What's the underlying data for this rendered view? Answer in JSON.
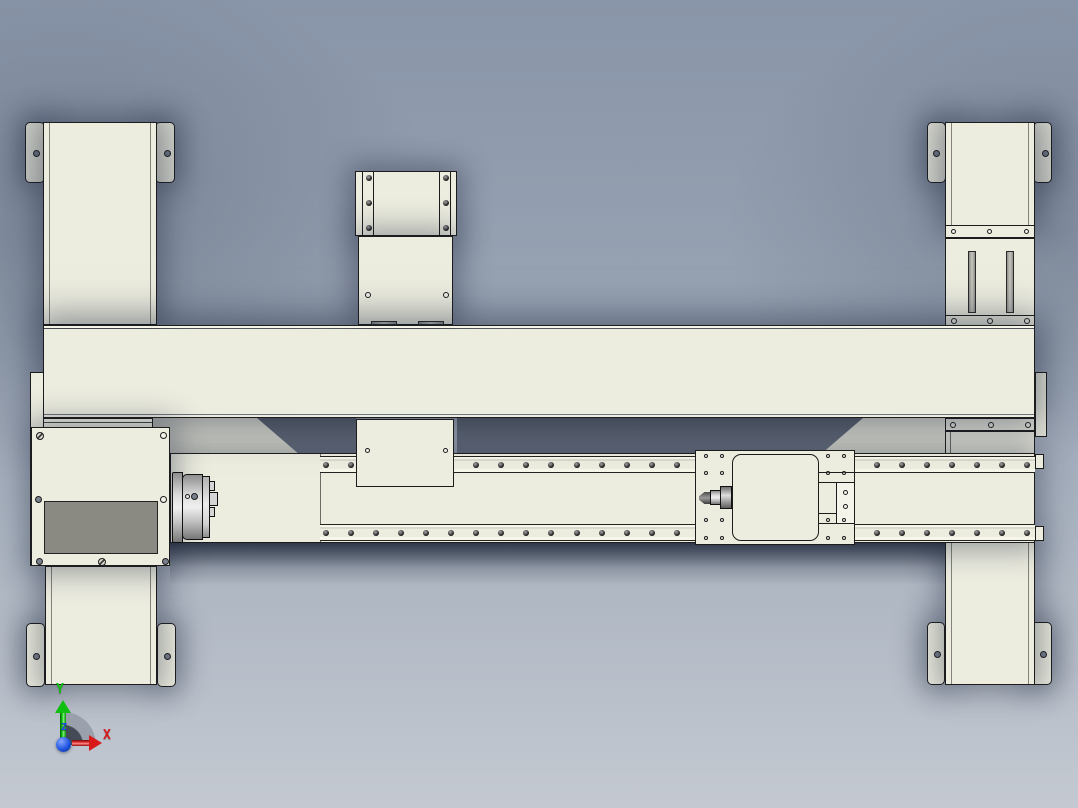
{
  "colors": {
    "bg_top": "#8995A8",
    "bg_bottom": "#C4C9D1",
    "part": "#ECECDF",
    "part_shade": "#E4E4D7",
    "edge": "#1C1C1C",
    "panel_gray": "#8A8A82",
    "hole_gray": "#78808D",
    "triad_x": "#D81A1A",
    "triad_y": "#0FBF0F",
    "triad_z": "#2244E0"
  },
  "triad": {
    "x": "X",
    "y": "Y",
    "z": "Z"
  },
  "bolt_rows": {
    "top_rail": {
      "count": 29,
      "x_start": 3,
      "spacing": 25.05,
      "y": 5,
      "size": 6
    },
    "bottom_rail": {
      "count": 29,
      "x_start": 3,
      "spacing": 25.05,
      "y": 5,
      "size": 6
    }
  },
  "details": {
    "col_tl_tab_l": [
      {
        "k": "pin",
        "x": 7,
        "y": 27
      }
    ],
    "col_tl_tab_r": [
      {
        "k": "pin",
        "x": 8,
        "y": 27
      }
    ],
    "col_tm_upper": [
      {
        "k": "bolt",
        "x": 10,
        "y": 3
      },
      {
        "k": "bolt",
        "x": 10,
        "y": 28
      },
      {
        "k": "bolt",
        "x": 10,
        "y": 53
      },
      {
        "k": "bolt",
        "x": 87,
        "y": 3
      },
      {
        "k": "bolt",
        "x": 87,
        "y": 28
      },
      {
        "k": "bolt",
        "x": 87,
        "y": 53
      }
    ],
    "col_tm_lower": [
      {
        "k": "hole",
        "x": 6,
        "y": 55
      },
      {
        "k": "hole",
        "x": 84,
        "y": 55
      },
      {
        "k": "slot",
        "x": 12,
        "y": 84,
        "w": 26,
        "h": 4
      },
      {
        "k": "slot",
        "x": 59,
        "y": 84,
        "w": 26,
        "h": 4
      }
    ],
    "col_tm_below": [
      {
        "k": "hole",
        "x": 8,
        "y": 28,
        "w": 5,
        "h": 5
      },
      {
        "k": "hole",
        "x": 86,
        "y": 28,
        "w": 5,
        "h": 5
      }
    ],
    "col_tr_tab_l": [
      {
        "k": "pin",
        "x": 5,
        "y": 27
      }
    ],
    "col_tr_tab_r": [
      {
        "k": "pin",
        "x": 8,
        "y": 27
      }
    ],
    "col_tr_strip1": [
      {
        "k": "hole",
        "x": 5,
        "y": 3,
        "w": 5,
        "h": 5
      },
      {
        "k": "hole",
        "x": 41,
        "y": 3,
        "w": 5,
        "h": 5
      },
      {
        "k": "hole",
        "x": 78,
        "y": 3,
        "w": 5,
        "h": 5
      }
    ],
    "col_tr_mid": [
      {
        "k": "slot",
        "x": 22,
        "y": 12,
        "w": 8,
        "h": 62
      },
      {
        "k": "slot",
        "x": 60,
        "y": 12,
        "w": 8,
        "h": 62
      }
    ],
    "col_tr_strip2": [
      {
        "k": "hole",
        "x": 5,
        "y": 2
      },
      {
        "k": "hole",
        "x": 41,
        "y": 2
      },
      {
        "k": "hole",
        "x": 78,
        "y": 2
      }
    ],
    "col_br_strip": [
      {
        "k": "hole",
        "x": 4,
        "y": 3
      },
      {
        "k": "hole",
        "x": 42,
        "y": 3
      },
      {
        "k": "hole",
        "x": 79,
        "y": 3
      }
    ],
    "col_bl_tab_l": [
      {
        "k": "pin",
        "x": 6,
        "y": 29
      }
    ],
    "col_bl_tab_r": [
      {
        "k": "pin",
        "x": 6,
        "y": 29
      }
    ],
    "col_br_tab_l": [
      {
        "k": "pin",
        "x": 6,
        "y": 28
      }
    ],
    "col_br_tab_r": [
      {
        "k": "pin",
        "x": 9,
        "y": 28
      }
    ],
    "headstock": [
      {
        "k": "screw",
        "x": 4,
        "y": 4,
        "w": 8,
        "h": 8
      },
      {
        "k": "hole",
        "x": 128,
        "y": 4,
        "w": 7,
        "h": 7
      },
      {
        "k": "pin",
        "x": 3,
        "y": 68
      },
      {
        "k": "hole",
        "x": 128,
        "y": 68,
        "w": 7,
        "h": 7
      },
      {
        "k": "pin",
        "x": 4,
        "y": 130
      },
      {
        "k": "screw",
        "x": 66,
        "y": 130,
        "w": 8,
        "h": 8
      },
      {
        "k": "pin",
        "x": 130,
        "y": 130
      }
    ],
    "chuck": [
      {
        "k": "hole",
        "x": 14,
        "y": 24,
        "w": 5,
        "h": 5
      },
      {
        "k": "pin",
        "x": 20,
        "y": 23
      }
    ],
    "carriage": [
      {
        "k": "hole",
        "x": 8,
        "y": 3,
        "w": 4,
        "h": 4
      },
      {
        "k": "hole",
        "x": 24,
        "y": 3,
        "w": 4,
        "h": 4
      },
      {
        "k": "hole",
        "x": 8,
        "y": 20,
        "w": 4,
        "h": 4
      },
      {
        "k": "hole",
        "x": 24,
        "y": 20,
        "w": 4,
        "h": 4
      },
      {
        "k": "hole",
        "x": 8,
        "y": 67,
        "w": 4,
        "h": 4
      },
      {
        "k": "hole",
        "x": 24,
        "y": 67,
        "w": 4,
        "h": 4
      },
      {
        "k": "hole",
        "x": 8,
        "y": 85,
        "w": 4,
        "h": 4
      },
      {
        "k": "hole",
        "x": 24,
        "y": 85,
        "w": 4,
        "h": 4
      },
      {
        "k": "hole",
        "x": 130,
        "y": 3,
        "w": 4,
        "h": 4
      },
      {
        "k": "hole",
        "x": 146,
        "y": 3,
        "w": 4,
        "h": 4
      },
      {
        "k": "hole",
        "x": 130,
        "y": 20,
        "w": 4,
        "h": 4
      },
      {
        "k": "hole",
        "x": 146,
        "y": 20,
        "w": 4,
        "h": 4
      },
      {
        "k": "hole",
        "x": 130,
        "y": 67,
        "w": 4,
        "h": 4
      },
      {
        "k": "hole",
        "x": 146,
        "y": 67,
        "w": 4,
        "h": 4
      },
      {
        "k": "hole",
        "x": 130,
        "y": 85,
        "w": 4,
        "h": 4
      },
      {
        "k": "hole",
        "x": 146,
        "y": 85,
        "w": 4,
        "h": 4
      }
    ],
    "carriage_block": [
      {
        "k": "hole",
        "x": 6,
        "y": 7,
        "w": 5,
        "h": 5
      },
      {
        "k": "hole",
        "x": 6,
        "y": 21,
        "w": 5,
        "h": 5
      }
    ]
  }
}
